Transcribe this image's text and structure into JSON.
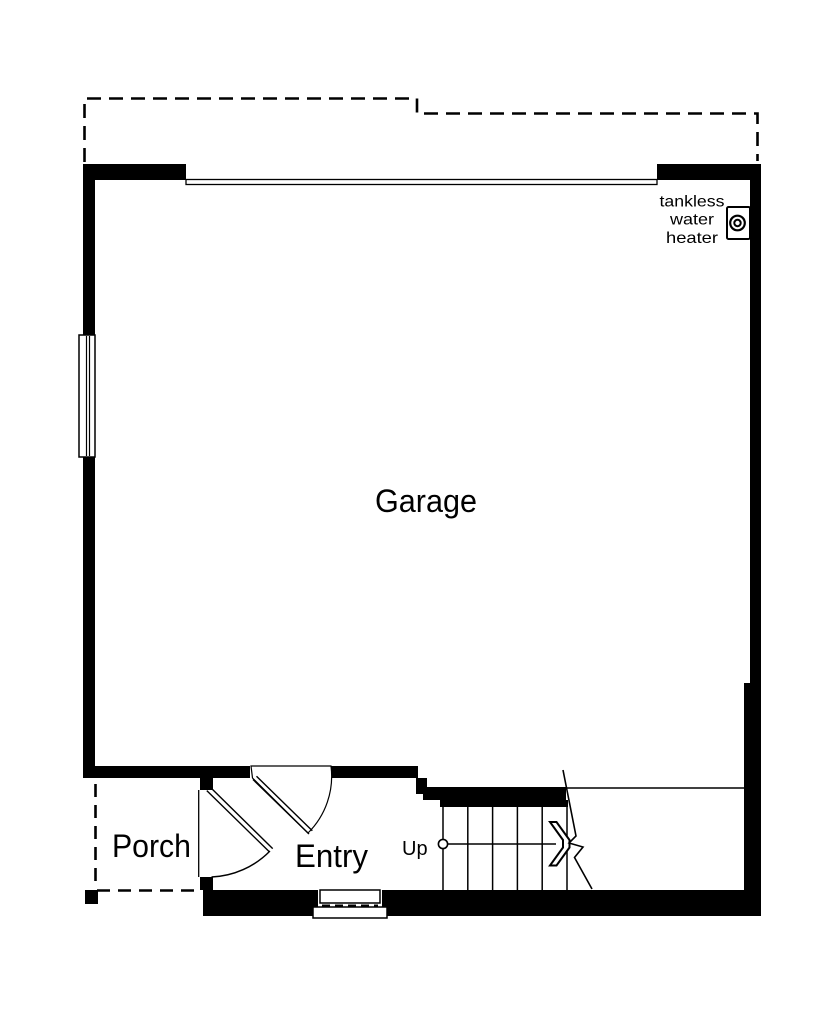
{
  "page": {
    "background": "#ffffff",
    "ink": "#000000"
  },
  "floor_plan": {
    "rooms": {
      "garage": "Garage",
      "porch": "Porch",
      "entry": "Entry"
    },
    "stairs": {
      "direction": "Up"
    },
    "water_heater": {
      "line1": "tankless",
      "line2": "water",
      "line3": "heater"
    }
  }
}
